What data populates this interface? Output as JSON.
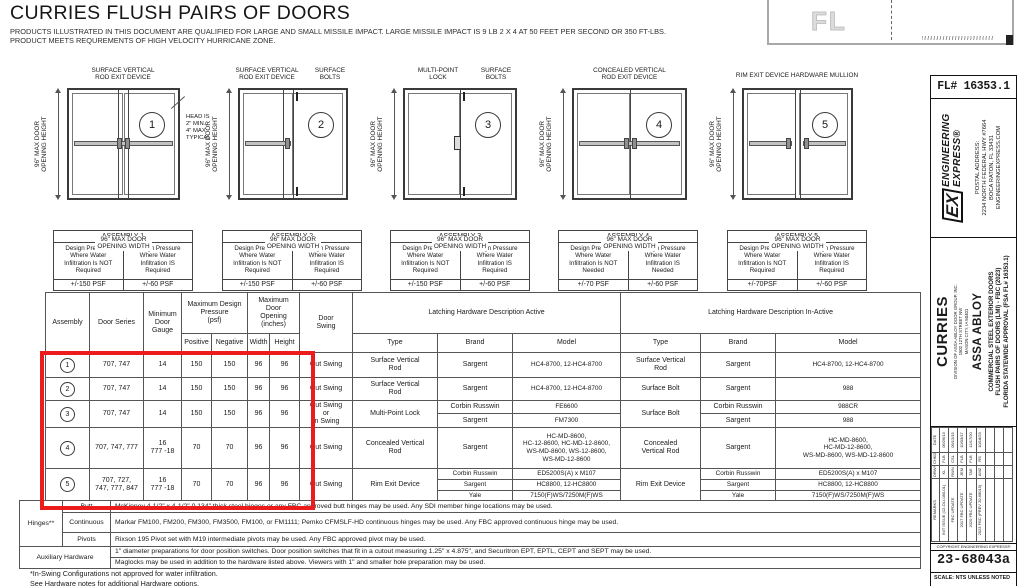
{
  "header": {
    "title": "CURRIES FLUSH PAIRS OF DOORS",
    "subtitle1": "PRODUCTS ILLUSTRATED IN THIS DOCUMENT ARE QUALIFIED FOR LARGE AND SMALL MISSILE IMPACT.  LARGE MISSILE IMPACT IS 9 LB 2 X 4 AT 50 FEET PER SECOND OR 350 FT-LBS.",
    "subtitle2": "PRODUCT MEETS REQUREMENTS OF HIGH VELOCITY HURRICANE ZONE."
  },
  "seal": {
    "watermark": "FL"
  },
  "diagrams": [
    {
      "num": "1",
      "label1": "SURFACE VERTICAL\nROD EXIT DEVICE",
      "height_label": "96\" MAX DOOR\nOPENING HEIGHT",
      "width_label": "96\" MAX DOOR\nOPENING WIDTH",
      "note": "HEAD IS\n2\" MIN.,\n4\" MAX\nTYPICAL"
    },
    {
      "num": "2",
      "label1": "SURFACE VERTICAL\nROD EXIT DEVICE",
      "label2": "SURFACE\nBOLTS",
      "height_label": "96\" MAX DOOR\nOPENING HEIGHT",
      "width_label": "96\" MAX DOOR\nOPENING WIDTH"
    },
    {
      "num": "3",
      "label1": "MULTI-POINT\nLOCK",
      "label2": "SURFACE\nBOLTS",
      "height_label": "96\" MAX DOOR\nOPENING HEIGHT",
      "width_label": "96\" MAX DOOR\nOPENING WIDTH"
    },
    {
      "num": "4",
      "label1": "CONCEALED VERTICAL\nROD EXIT DEVICE",
      "height_label": "96\" MAX DOOR\nOPENING HEIGHT",
      "width_label": "96\" MAX DOOR\nOPENING WIDTH"
    },
    {
      "num": "5",
      "label1": "RIM EXIT DEVICE HARDWARE MULLION",
      "height_label": "96\" MAX DOOR\nOPENING HEIGHT",
      "width_label": "96\" MAX DOOR\nOPENING WIDTH"
    }
  ],
  "assemblies": [
    {
      "title": "ASSEMBLY 1",
      "left_header": "Design Pressure\nWhere Water\nInfiltration Is NOT\nRequired",
      "left_value": "+/-150 PSF",
      "right_header": "Design Pressure\nWhere Water\nInfiltration IS\nRequired",
      "right_value": "+/-60 PSF"
    },
    {
      "title": "ASSEMBLY 2",
      "left_header": "Design Pressure\nWhere Water\nInfiltration Is NOT\nRequired",
      "left_value": "+/-150 PSF",
      "right_header": "Design Pressure\nWhere Water\nInfiltration IS\nRequired",
      "right_value": "+/-60 PSF"
    },
    {
      "title": "ASSEMBLY 3",
      "left_header": "Design Pressure\nWhere Water\nInfiltration Is NOT\nRequired",
      "left_value": "+/-150 PSF",
      "right_header": "Design Pressure\nWhere Water\nInfiltration IS\nRequired",
      "right_value": "+/-60 PSF"
    },
    {
      "title": "ASSEMBLY 4",
      "left_header": "Design Pressure\nWhere Water\nInfiltration Is NOT\nNeeded",
      "left_value": "+/-70 PSF",
      "right_header": "Design Pressure\nWhere Water\nInfiltration IS\nNeeded",
      "right_value": "+/-60 PSF"
    },
    {
      "title": "ASSEMBLY 5",
      "left_header": "Design Pressure\nWhere Water\nInfiltration Is NOT\nRequired",
      "left_value": "+/-70PSF",
      "right_header": "Design Pressure\nWhere Water\nInfiltration IS\nRequired",
      "right_value": "+/-60 PSF"
    }
  ],
  "spec_table": {
    "headers": {
      "assembly": "Assembly",
      "door_series": "Door Series",
      "min_gauge": "Minimum\nDoor\nGauge",
      "max_pressure": "Maximum Design\nPressure\n(psf)",
      "positive": "Positive",
      "negative": "Negative",
      "max_opening": "Maximum\nDoor\nOpening\n(inches)",
      "width": "Width",
      "height": "Height",
      "door_swing": "Door\nSwing",
      "active": "Latching Hardware Description Active",
      "inactive": "Latching Hardware Description In-Active",
      "type": "Type",
      "brand": "Brand",
      "model": "Model"
    },
    "rows": [
      {
        "num": "1",
        "series": "707, 747",
        "gauge": "14",
        "positive": "150",
        "negative": "150",
        "width": "96",
        "height": "96",
        "swing": "Out Swing",
        "active_type": "Surface Vertical\nRod",
        "active_entries": [
          {
            "brand": "Sargent",
            "model": "HC4-8700, 12-HC4-8700"
          }
        ],
        "inactive_type": "Surface Vertical\nRod",
        "inactive_entries": [
          {
            "brand": "Sargent",
            "model": "HC4-8700, 12-HC4-8700"
          }
        ]
      },
      {
        "num": "2",
        "series": "707, 747",
        "gauge": "14",
        "positive": "150",
        "negative": "150",
        "width": "96",
        "height": "96",
        "swing": "Out Swing",
        "active_type": "Surface Vertical\nRod",
        "active_entries": [
          {
            "brand": "Sargent",
            "model": "HC4-8700, 12-HC4-8700"
          }
        ],
        "inactive_type": "Surface Bolt",
        "inactive_entries": [
          {
            "brand": "Sargent",
            "model": "988"
          }
        ]
      },
      {
        "num": "3",
        "series": "707, 747",
        "gauge": "14",
        "positive": "150",
        "negative": "150",
        "width": "96",
        "height": "96",
        "swing": "Out Swing\nor\nIn Swing",
        "active_type": "Multi-Point Lock",
        "active_entries": [
          {
            "brand": "Corbin Russwin",
            "model": "FE6600"
          },
          {
            "brand": "Sargent",
            "model": "FM7300"
          }
        ],
        "inactive_type": "Surface Bolt",
        "inactive_entries": [
          {
            "brand": "Corbin Russwin",
            "model": "988CR"
          },
          {
            "brand": "Sargent",
            "model": "988"
          }
        ]
      },
      {
        "num": "4",
        "series": "707, 747, 777",
        "gauge": "16\n777 -18",
        "positive": "70",
        "negative": "70",
        "width": "96",
        "height": "96",
        "swing": "Out Swing",
        "active_type": "Concealed Vertical\nRod",
        "active_entries": [
          {
            "brand": "Sargent",
            "model": "HC-MD-8600,\nHC-12-8600, HC-MD-12-8600,\nWS-MD-8600, WS-12-8600,\nWS-MD-12-8600"
          }
        ],
        "inactive_type": "Concealed\nVertical Rod",
        "inactive_entries": [
          {
            "brand": "Sargent",
            "model": "HC-MD-8600,\nHC-MD-12-8600,\nWS-MD-8600, WS-MD-12-8600"
          }
        ]
      },
      {
        "num": "5",
        "series": "707, 727,\n747, 777, 847",
        "gauge": "16\n777 -18",
        "positive": "70",
        "negative": "70",
        "width": "96",
        "height": "96",
        "swing": "Out Swing",
        "active_type": "Rim Exit Device",
        "active_entries": [
          {
            "brand": "Corbin Russwin",
            "model": "ED5200S(A) x M107"
          },
          {
            "brand": "Sargent",
            "model": "HC8800, 12-HC8800"
          },
          {
            "brand": "Yale",
            "model": "7150(F)WS/7250M(F)WS"
          }
        ],
        "inactive_type": "Rim Exit Device",
        "inactive_entries": [
          {
            "brand": "Corbin Russwin",
            "model": "ED5200S(A) x M107"
          },
          {
            "brand": "Sargent",
            "model": "HC8800, 12-HC8800"
          },
          {
            "brand": "Yale",
            "model": "7150(F)WS/7250M(F)WS"
          }
        ]
      }
    ]
  },
  "hardware_table": {
    "hinges_label": "Hinges**",
    "butt_label": "Butt",
    "butt_text": "McKinney 4-1/2\" x 4-1/2\" 0.134\" thick steel hinges or any FBC approved butt hinges may be used.   Any SDI member hinge locations may be used.",
    "continuous_label": "Continuous",
    "continuous_text": "Markar FM100, FM200, FM300, FM3500, FM100, or FM1111; Pemko CFMSLF-HD continuous hinges may be used. Any FBC approved continuous hinge may be used.",
    "pivots_label": "Pivots",
    "pivots_text": "Rixson 195 Pivot set with M19 intermediate pivots may be used. Any FBC approved pivot may be used.",
    "aux_label": "Auxiliary Hardware",
    "aux_text1": "1\" diameter preparations for door position switches. Door position switches that fit in a cutout measuring 1.25\" x 4.875\", and Securitron EPT, EPTL,  CEPT and SEPT may be used.",
    "aux_text2": "Maglocks may be used in addition to the hardware listed above.   Viewers with 1\" and smaller hole preparation may be used."
  },
  "footnotes": {
    "line1": "*In-Swing Configurations not approved for water infiltration.",
    "line2": "See Hardware notes for additional Hardware options."
  },
  "title_block": {
    "fl_number": "FL# 16353.1",
    "ee": {
      "logo": "EX",
      "name1": "ENGINEERING",
      "name2": "EXPRESS®",
      "address_label": "POSTAL ADDRESS:",
      "address1": "2234 NORTH FEDERAL HWY #7664",
      "address2": "BOCA RATON, FL 33431",
      "website": "ENGINEERINGEXPRESS.COM"
    },
    "client": {
      "name": "CURRIES",
      "division": "DIVISION OF ASSA ABLOY DOOR GROUP, INC.",
      "street": "1502 12TH STREET NW",
      "city": "MASON CITY, IA 50401",
      "parent": "ASSA ABLOY",
      "desc1": "COMMERCIAL STEEL EXTERIOR DOORS",
      "desc2": "FLUSH PAIRS OF DOORS (LMI) - FBC (2023)",
      "desc3": "FLORIDA STATEWIDE APPROVAL (FSA FL# 16353.1)"
    },
    "revisions": {
      "remarks_h": "REMARKS",
      "drwn_h": "DRWN",
      "chkd_h": "CHKD",
      "date_h": "DATE",
      "rows": [
        {
          "remarks": "INIT ISSUE (12-OLI-080-01)",
          "drwn": "KL",
          "chkd": "FLB",
          "date": "06/26/13"
        },
        {
          "remarks": "FBC UPDATE",
          "drwn": "RWN",
          "chkd": "CSL",
          "date": "09/12/15"
        },
        {
          "remarks": "2017 FBC UPDATE",
          "drwn": "JEM",
          "chkd": "FLB",
          "date": "10/03/17"
        },
        {
          "remarks": "2020 FBC UPDATE",
          "drwn": "TAE",
          "chkd": "FLB",
          "date": "12/17/20"
        },
        {
          "remarks": "2023 FBC (PREV 20-68015)",
          "drwn": "AMZ",
          "chkd": "RS",
          "date": "10/18/23"
        }
      ]
    },
    "copyright": "COPYRIGHT ENGINEERING EXPRESS®",
    "drawing_number": "23-68043a",
    "scale": "SCALE: NTS UNLESS NOTED"
  }
}
